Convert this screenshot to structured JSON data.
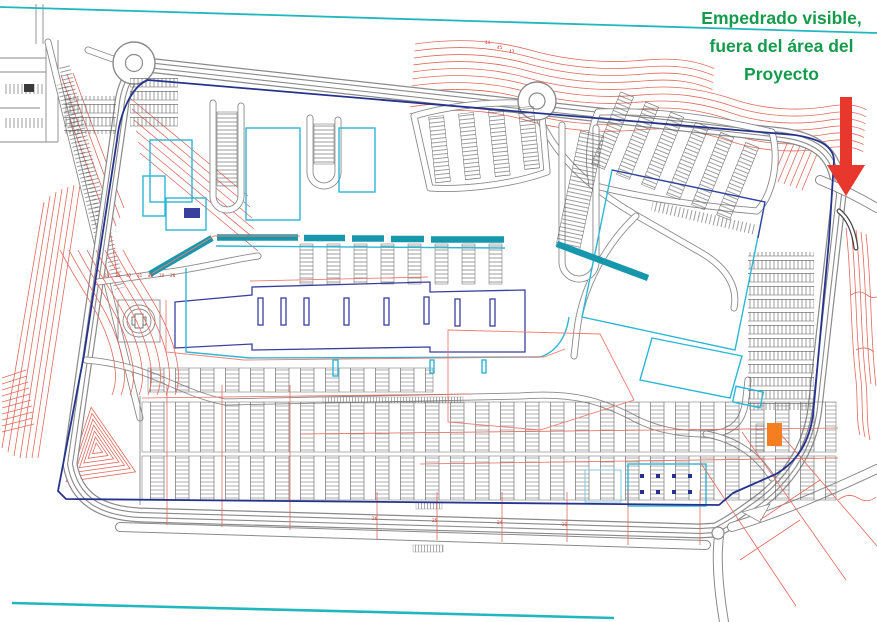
{
  "annotation": {
    "line1": "Empedrado visible,",
    "line2": "fuera del área del",
    "line3": "Proyecto"
  },
  "labels": {
    "bottom_road_sections": [
      "26",
      "25",
      "24",
      "21"
    ],
    "plaza_sections": [
      "34",
      "33",
      "32",
      "31",
      "30",
      "29",
      "28"
    ],
    "contour_elevations": [
      "44",
      "45",
      "43"
    ]
  },
  "colors": {
    "annotation_green": "#149b4c",
    "arrow_red": "#e8372c",
    "boundary_blue": "#26338e",
    "building_cyan": "#2bb7d5",
    "building_navy": "#3a3f9f",
    "canopy_teal": "#1797ac",
    "contour_red": "#e2695e",
    "road_gray": "#8a8a8a",
    "marker_orange": "#f57e20",
    "survey_line_teal": "#21b7be"
  }
}
